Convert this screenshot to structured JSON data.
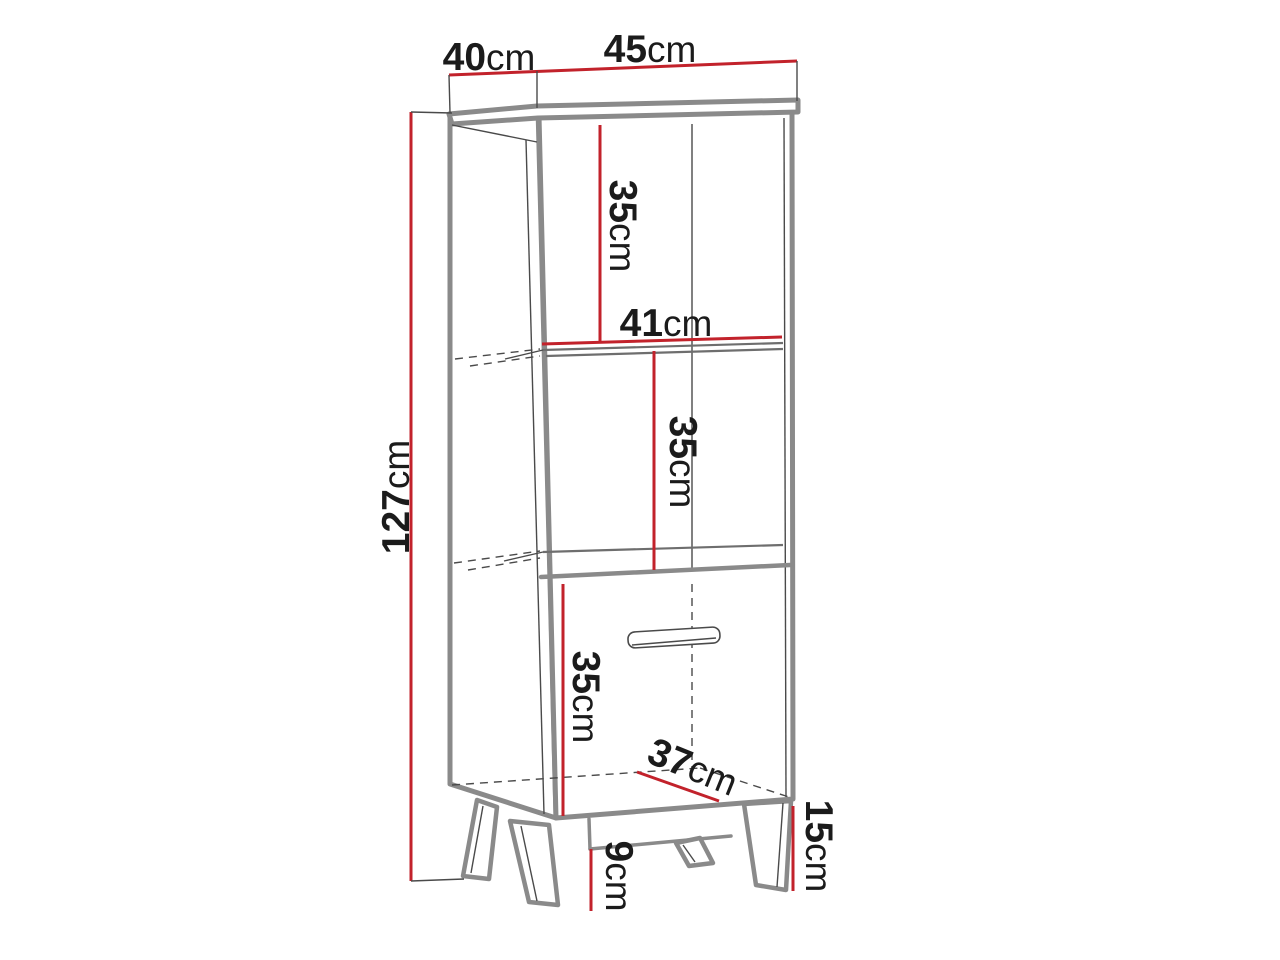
{
  "diagram": {
    "type": "furniture-dimension-drawing",
    "background": "#ffffff",
    "colors": {
      "outline_gray": "#8a8a8a",
      "thin_line": "#4a4a4a",
      "dimension_red": "#c2222b",
      "text_black": "#1b1b1b",
      "shelf_gray": "#6e6e6e",
      "background": "#ffffff"
    },
    "dimensions": [
      {
        "id": "top-depth",
        "value": "40",
        "unit": "cm"
      },
      {
        "id": "top-width",
        "value": "45",
        "unit": "cm"
      },
      {
        "id": "total-height",
        "value": "127",
        "unit": "cm"
      },
      {
        "id": "upper-shelf-height",
        "value": "35",
        "unit": "cm"
      },
      {
        "id": "shelf-width",
        "value": "41",
        "unit": "cm"
      },
      {
        "id": "middle-shelf-height",
        "value": "35",
        "unit": "cm"
      },
      {
        "id": "door-section-height",
        "value": "35",
        "unit": "cm"
      },
      {
        "id": "bottom-depth",
        "value": "37",
        "unit": "cm"
      },
      {
        "id": "leg-height",
        "value": "15",
        "unit": "cm"
      },
      {
        "id": "leg-clearance",
        "value": "9",
        "unit": "cm"
      }
    ]
  }
}
